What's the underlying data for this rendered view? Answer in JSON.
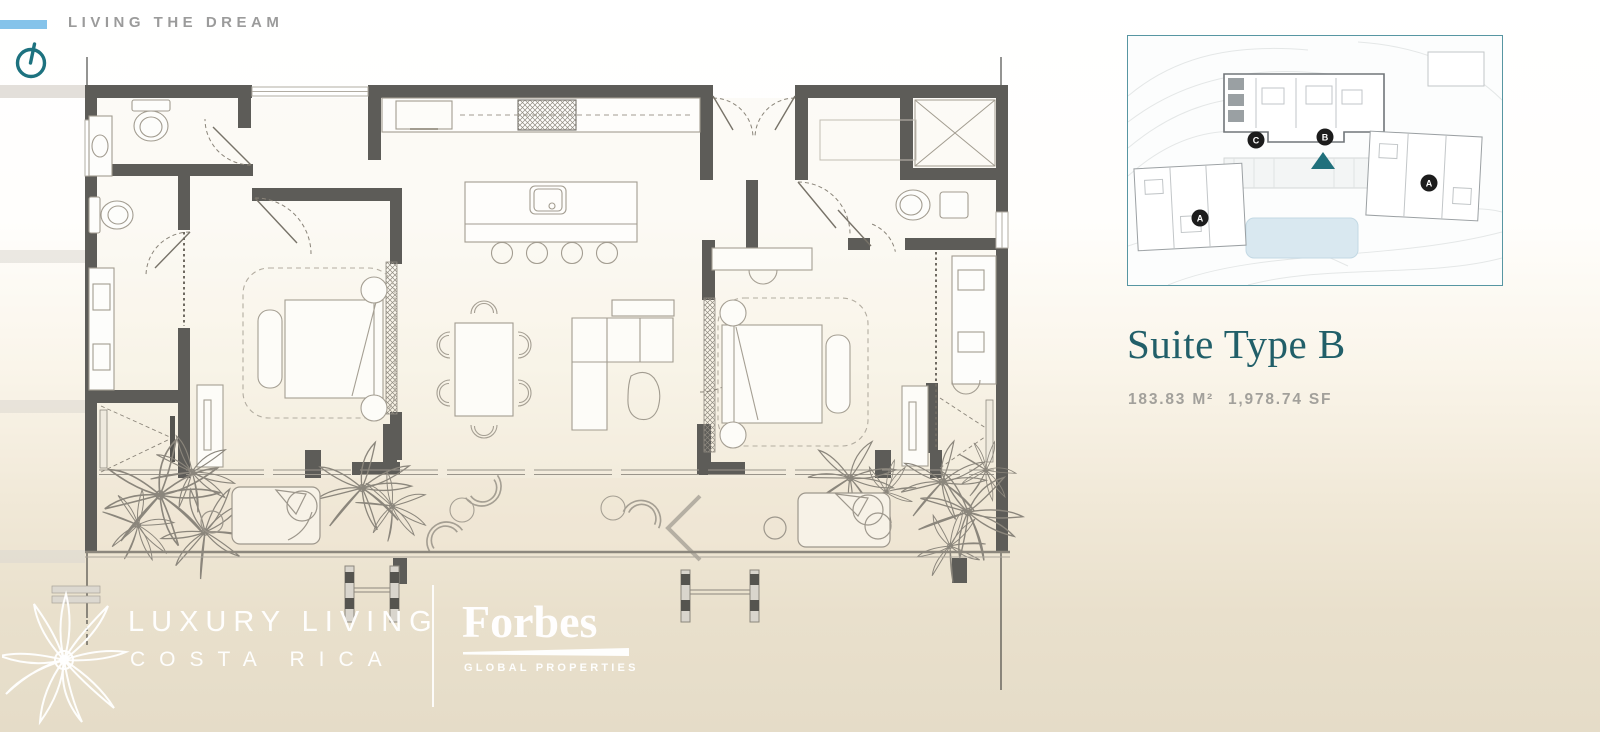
{
  "header": {
    "tagline": "LIVING THE DREAM"
  },
  "suite_panel": {
    "title": "Suite Type B",
    "area_m2": "183.83 M²",
    "area_sf": "1,978.74 SF"
  },
  "site_plan": {
    "marker_c": "C",
    "marker_b": "B",
    "marker_a_left": "A",
    "marker_a_right": "A"
  },
  "footer": {
    "brand_line1": "LUXURY LIVING",
    "brand_line2": "COSTA RICA",
    "partner": "Forbes",
    "partner_tagline": "GLOBAL PROPERTIES"
  },
  "icons": {
    "north_indicator": "power-style dial circle with tilted stem",
    "palm_logo": "thin eight-petal palm flower",
    "suite_location_marker": "teal triangle pointing up"
  },
  "colors": {
    "accent_teal": "#1e6e7a",
    "title_teal": "#215f69",
    "bar_blue": "#85c3ea",
    "wall_gray": "#5d5c58",
    "tagline_gray": "#9b9b9b",
    "area_text_gray": "#a2a09b",
    "background_bottom": "#e5dcc8",
    "inset_border_teal": "#5796a2",
    "marker_black": "#1c1c1c",
    "pool_blue": "#d9e8f0"
  }
}
